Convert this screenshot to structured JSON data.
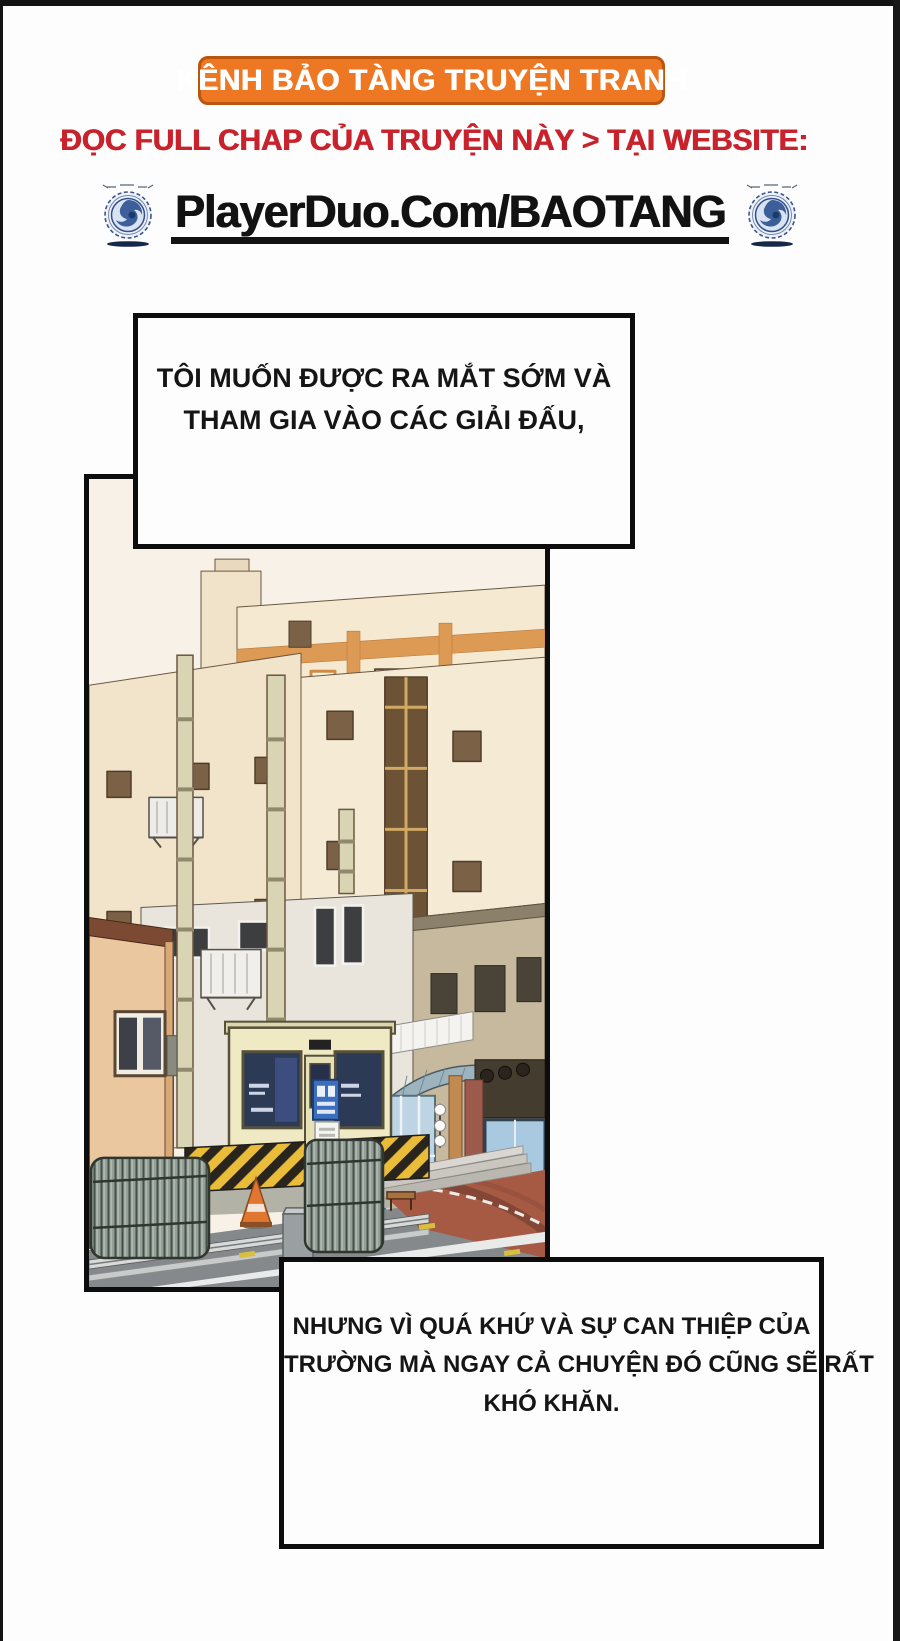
{
  "page": {
    "background": "#fdfdfd",
    "frame_color": "#131313"
  },
  "header": {
    "banner": {
      "label": "KÊNH BẢO TÀNG TRUYỆN TRANH",
      "bg": "#ee7723",
      "border": "#bc560f",
      "text_color": "#ffffff"
    },
    "subtitle": {
      "label": "ĐỌC FULL CHAP CỦA TRUYỆN NÀY > TẠI WEBSITE:",
      "color": "#c8232c"
    },
    "website": {
      "label": "PlayerDuo.Com/BAOTANG",
      "color": "#121212"
    },
    "logos": {
      "left_icon": "globe-emblem-icon",
      "right_icon": "globe-emblem-icon",
      "primary": "#2a4f8f",
      "light": "#dfe8f4"
    }
  },
  "bubbles": {
    "first": {
      "line1": "TÔI MUỐN ĐƯỢC RA MẮT SỚM VÀ",
      "line2": "THAM GIA VÀO CÁC GIẢI ĐẤU,"
    },
    "second": {
      "line1": "NHƯNG VÌ QUÁ KHỨ VÀ SỰ CAN THIỆP CỦA",
      "line2": "TRƯỜNG MÀ NGAY CẢ CHUYỆN ĐÓ CŨNG SẼ RẤT",
      "line3": "KHÓ KHĂN."
    }
  },
  "panel": {
    "scene": "street view: cream apartment buildings with orange trim, guard booth with hazard-striped barriers, folding metal gates, shops and red pavement",
    "colors": {
      "sky": "#f8f1e7",
      "wall": "#f3e6cf",
      "accent": "#dd9a55",
      "gate": "#94a097",
      "hazard_yellow": "#e9bd3a",
      "road": "#85898b",
      "pavement_red": "#a65a44",
      "booth": "#efe9c4"
    }
  }
}
